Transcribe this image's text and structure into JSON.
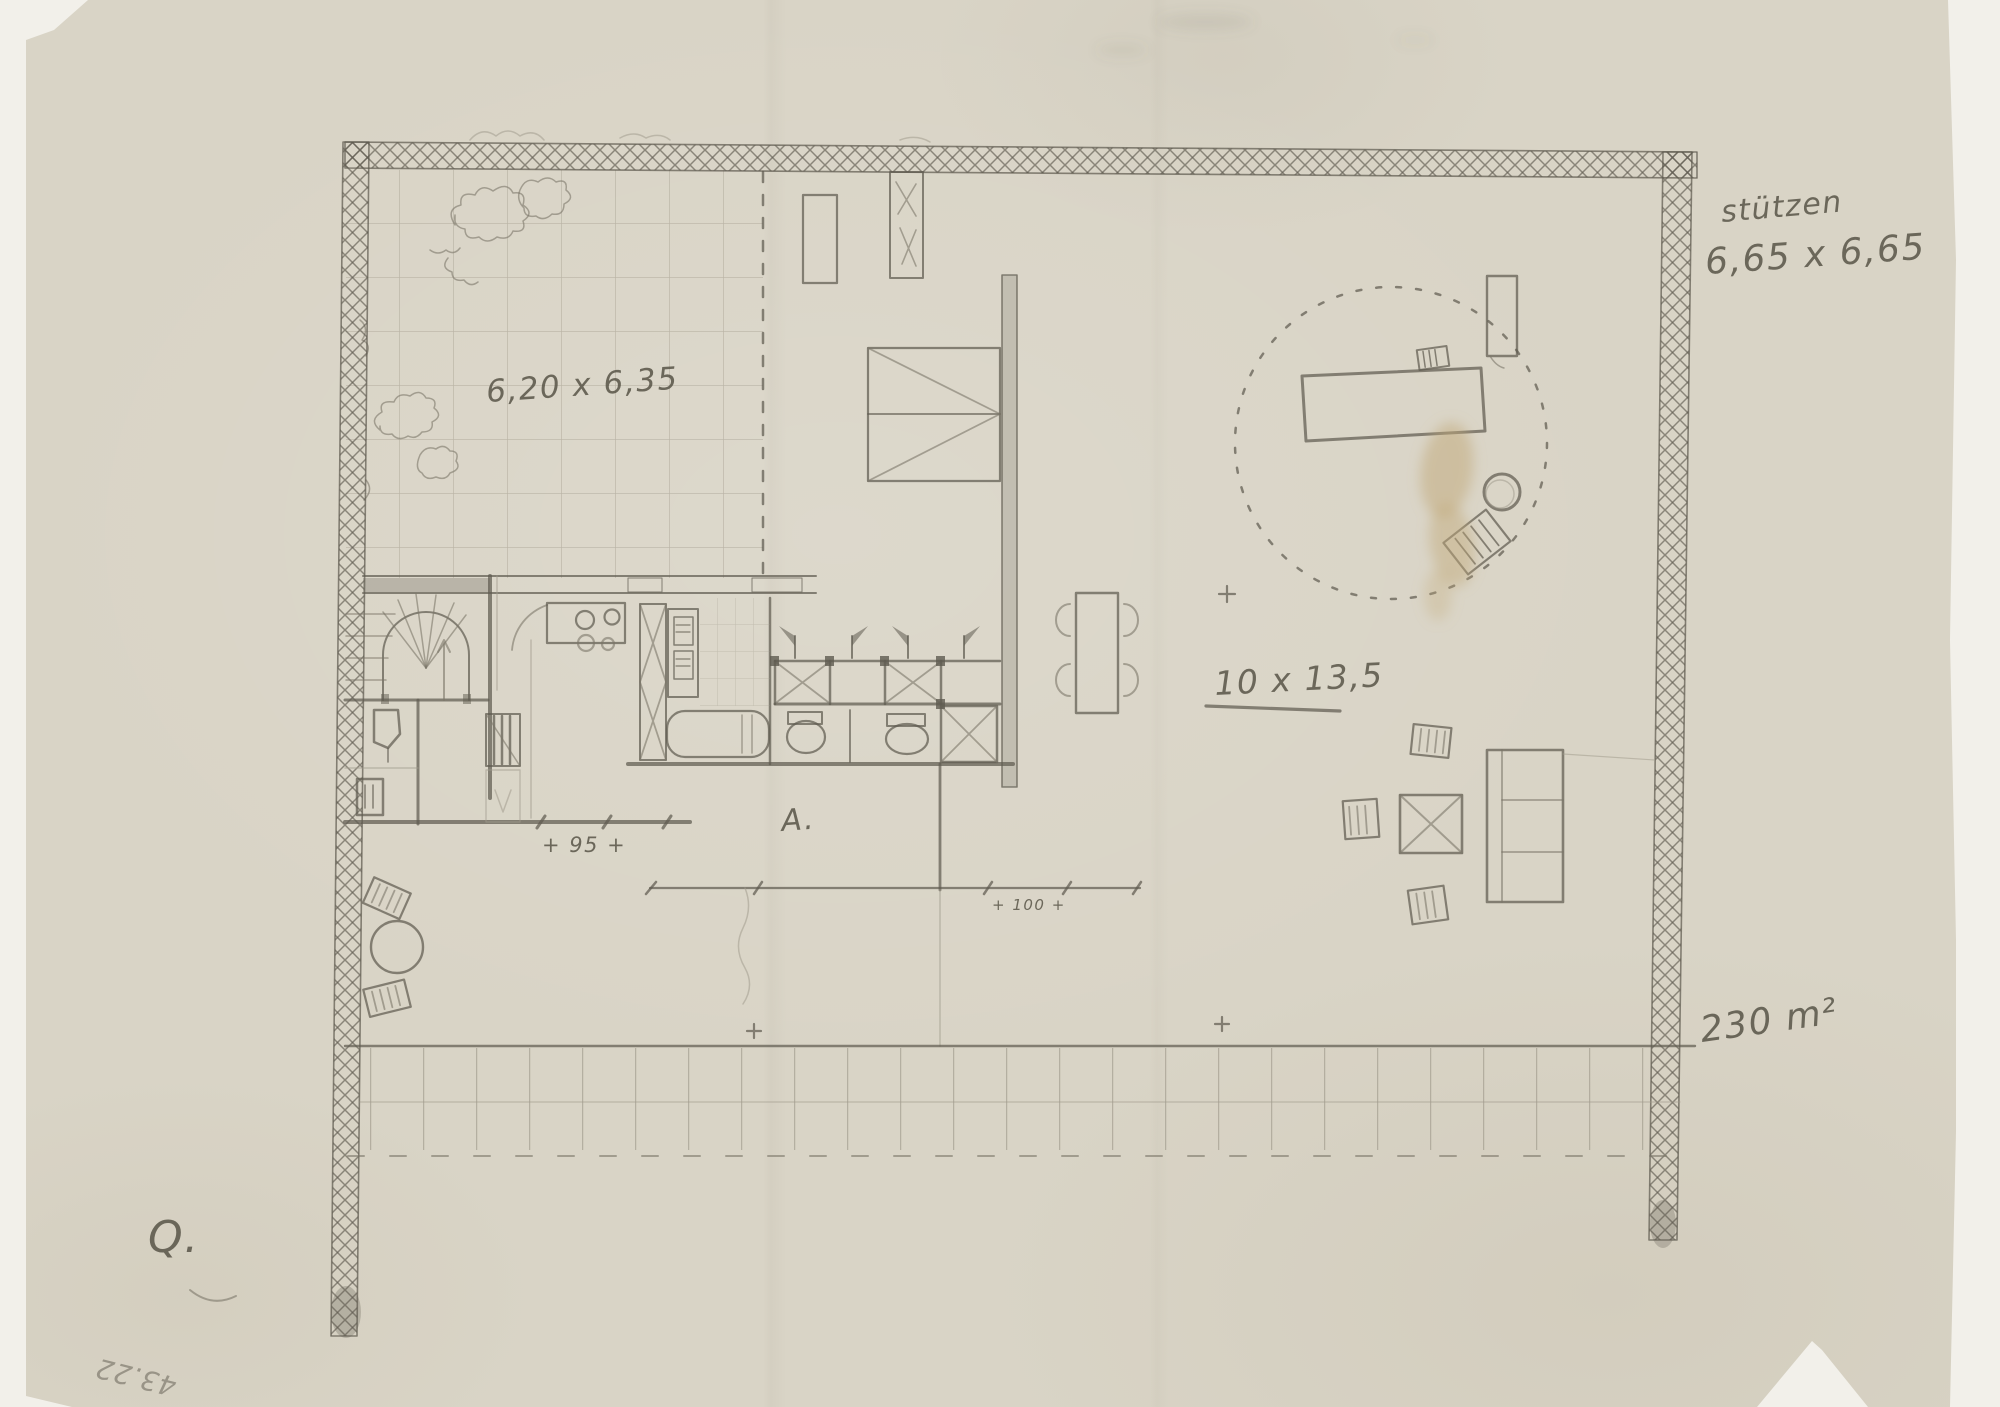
{
  "palette": {
    "scanner_background": "#f2f0ea",
    "paper": "#d9d4c6",
    "pencil_dark": "#5f5b50",
    "pencil_mid": "#7c7769",
    "pencil_light": "#a39d8e",
    "stain": "#c2a878"
  },
  "annotations": {
    "columns_label": "stützen",
    "columns_dims": "6,65 x 6,65",
    "roof_garden_dims": "6,20 x 6,35",
    "living_area_dims": "10 x 13,5",
    "total_area": "230 m²",
    "dimension_95": "+ 95 +",
    "dimension_100": "+ 100 +",
    "section_mark": "A.",
    "sheet_mark": "Q.",
    "inventory_number": "43.22"
  }
}
